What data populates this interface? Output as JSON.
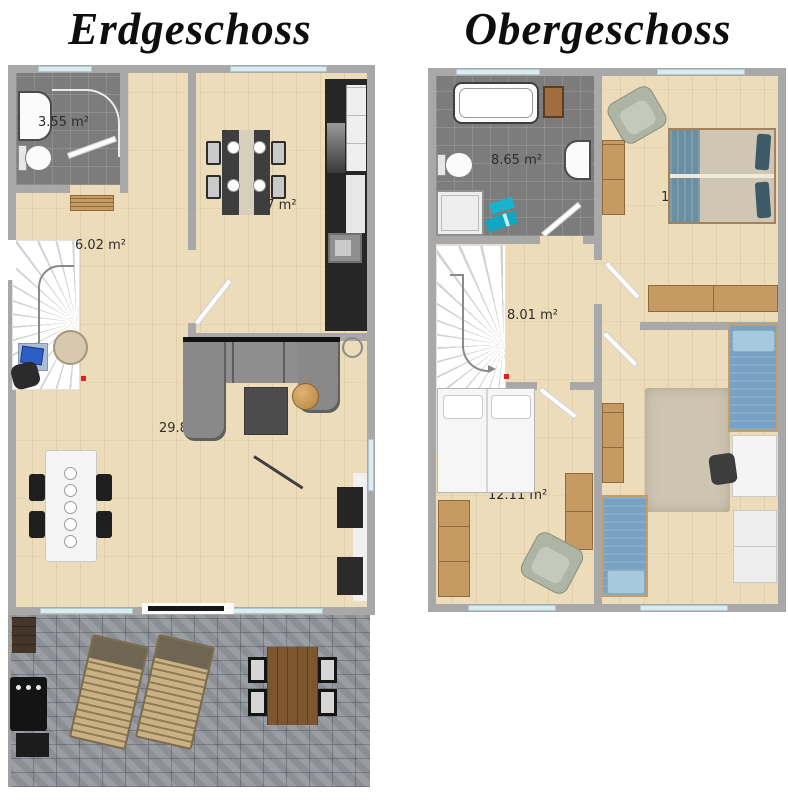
{
  "titles": {
    "ground": "Erdgeschoss",
    "upper": "Obergeschoss"
  },
  "ground_floor": {
    "labels": {
      "bathroom": "3.55 m²",
      "hallway": "6.02 m²",
      "kitchen": "27 m²",
      "living_room": "29.8"
    }
  },
  "upper_floor": {
    "labels": {
      "bathroom": "8.65 m²",
      "landing": "8.01 m²",
      "bedroom_double": "1",
      "bedroom_twin": "12.11 m²"
    }
  },
  "colors": {
    "wall": "#a8a8a8",
    "wood_floor": "#ecdcba",
    "tile_floor": "#7c7c7c",
    "terrace_stone": "#94979e",
    "window_glass": "#d8ecf2",
    "sofa_gray": "#8e8e8e",
    "bed_blue": "#79a2c2",
    "pillow_teal": "#3e5a68",
    "towel_cyan": "#18b2cd",
    "armchair_sage": "#aeb5a4",
    "wood_furniture": "#c59a63",
    "marker_red": "#e02020"
  }
}
